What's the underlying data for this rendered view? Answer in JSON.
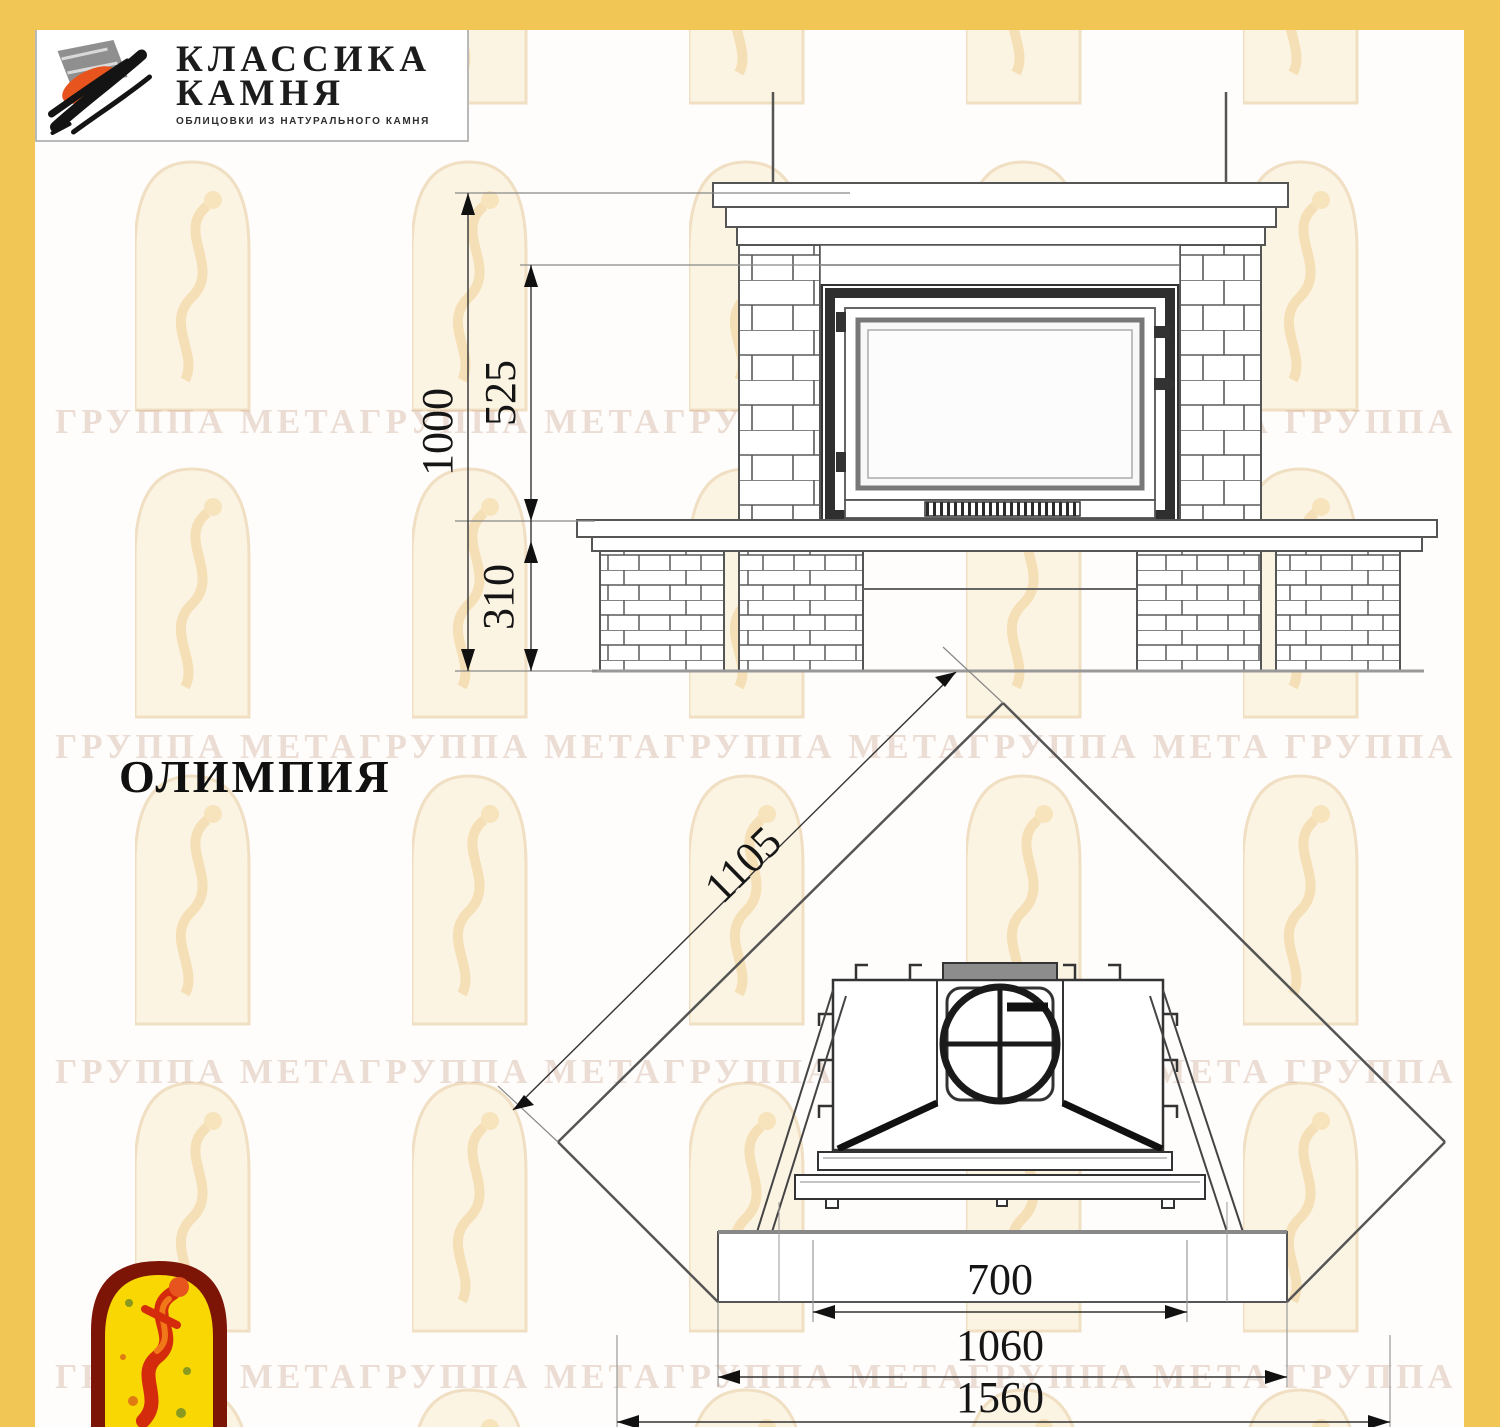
{
  "logo": {
    "title_line1": "КЛАССИКА",
    "title_line2": "КАМНЯ",
    "subtitle": "ОБЛИЦОВКИ ИЗ НАТУРАЛЬНОГО КАМНЯ"
  },
  "model": {
    "name": "ОЛИМПИЯ"
  },
  "watermark": {
    "text": "ГРУППА МЕТАГРУППА МЕТАГРУППА МЕТАГРУППА МЕТА ГРУППА МЕТАГРУППА"
  },
  "front_view": {
    "dim_total_height": "1000",
    "dim_firebox_height": "525",
    "dim_base_height": "310"
  },
  "plan_view": {
    "dim_side_wall": "1105",
    "dim_firebox_width": "700",
    "dim_hearth_width": "1060",
    "dim_total_width": "1560"
  },
  "colors": {
    "frame_yellow": "#F1C654",
    "logo_orange": "#E8541E",
    "emblem_dark_red": "#7D1507",
    "emblem_yellow": "#F8D703",
    "figure_red": "#D42B0C"
  }
}
